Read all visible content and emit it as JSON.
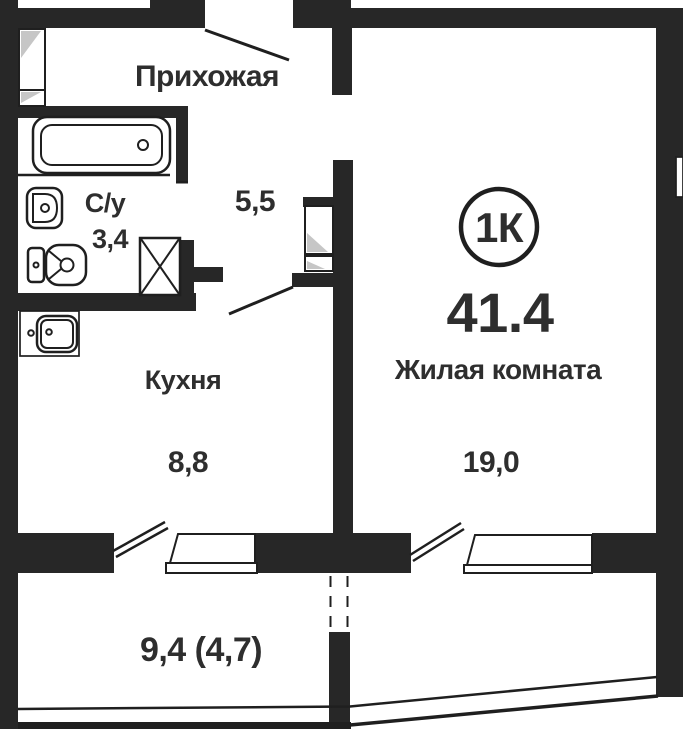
{
  "plan": {
    "badge": {
      "label": "1К"
    },
    "total_area": "41.4",
    "rooms": {
      "hallway": {
        "label": "Прихожая",
        "area": "5,5"
      },
      "bathroom": {
        "label": "С/у",
        "area": "3,4"
      },
      "kitchen": {
        "label": "Кухня",
        "area": "8,8"
      },
      "living_room": {
        "label": "Жилая комната",
        "area": "19,0"
      },
      "balcony": {
        "area": "9,4 (4,7)"
      }
    },
    "colors": {
      "wall": "#272727",
      "line": "#1f1f1f",
      "text": "#2e2e2e",
      "shade": "#c6c6c6"
    }
  }
}
